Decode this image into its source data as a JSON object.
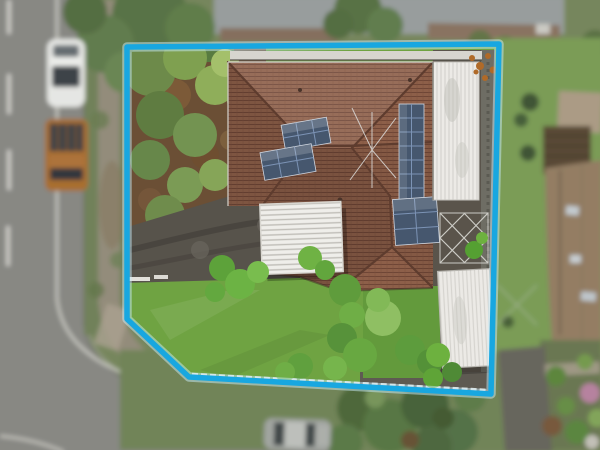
{
  "image": {
    "type": "aerial-drone-photograph",
    "subject": "top-down aerial photo of a residential corner block with a highlighted property boundary",
    "width_px": 600,
    "height_px": 450
  },
  "boundary_overlay": {
    "points": "127,47 499,44 491,394 189,377 127,319",
    "stroke_color": "#18a7e0",
    "glow_color": "#c8ecfa",
    "stroke_width": 5.5,
    "glow_width": 9.5
  },
  "palette": {
    "road": "#8d8c88",
    "road_marking": "#dddbd5",
    "kerb": "#686662",
    "footpath": "#9b9181",
    "outside_base": "#7a8a5f",
    "neighbor_lawn": "#7fa258",
    "neighbor_roof_gray": "#a3a7a8",
    "neighbor_roof_tan": "#9a8166",
    "lawn_main": "#6fa342",
    "lawn_secondary": "#639a3c",
    "garden_soil": "#6b4f35",
    "driveway": "#57534b",
    "roof_tile": "#8d5f49",
    "roof_ridge": "#5e3c2e",
    "white_roof": "#e9e8e4",
    "pergola_white": "#efeeea",
    "solar_panel": "#46576e",
    "solar_grid": "#7c93b5",
    "tree_dark": "#4f6b3b",
    "tree_mid": "#62804c",
    "tree_bright": "#6fae3c"
  },
  "scene": {
    "property": {
      "house_label": "main house with terracotta tile hip roof",
      "solar_arrays": [
        {
          "label": "twin tilted solar arrays on west roof plane"
        },
        {
          "label": "vertical strip of solar panels on east roof plane"
        },
        {
          "label": "square solar array on lower east roof plane"
        }
      ],
      "structures": [
        {
          "label": "white metal garage roof"
        },
        {
          "label": "white slatted pergola"
        },
        {
          "label": "white corrugated carport"
        },
        {
          "label": "open lattice frame"
        }
      ],
      "grounds": [
        {
          "label": "front lawn"
        },
        {
          "label": "side lawn"
        },
        {
          "label": "tree garden in north-west corner"
        },
        {
          "label": "dark asphalt driveway from street"
        }
      ]
    },
    "surroundings": {
      "street_label": "street along west side curving around the south corner",
      "vehicles": [
        {
          "label": "white car parked on street",
          "color": "#f2f2f0"
        },
        {
          "label": "orange utility truck parked on street",
          "color": "#b0712f"
        },
        {
          "label": "silver car on south street",
          "color": "#a8aba7"
        }
      ],
      "neighbors": [
        {
          "label": "grey corrugated roof house to the north"
        },
        {
          "label": "tan roofed house with cottage garden to the east"
        },
        {
          "label": "dense street trees to the south"
        }
      ]
    }
  }
}
